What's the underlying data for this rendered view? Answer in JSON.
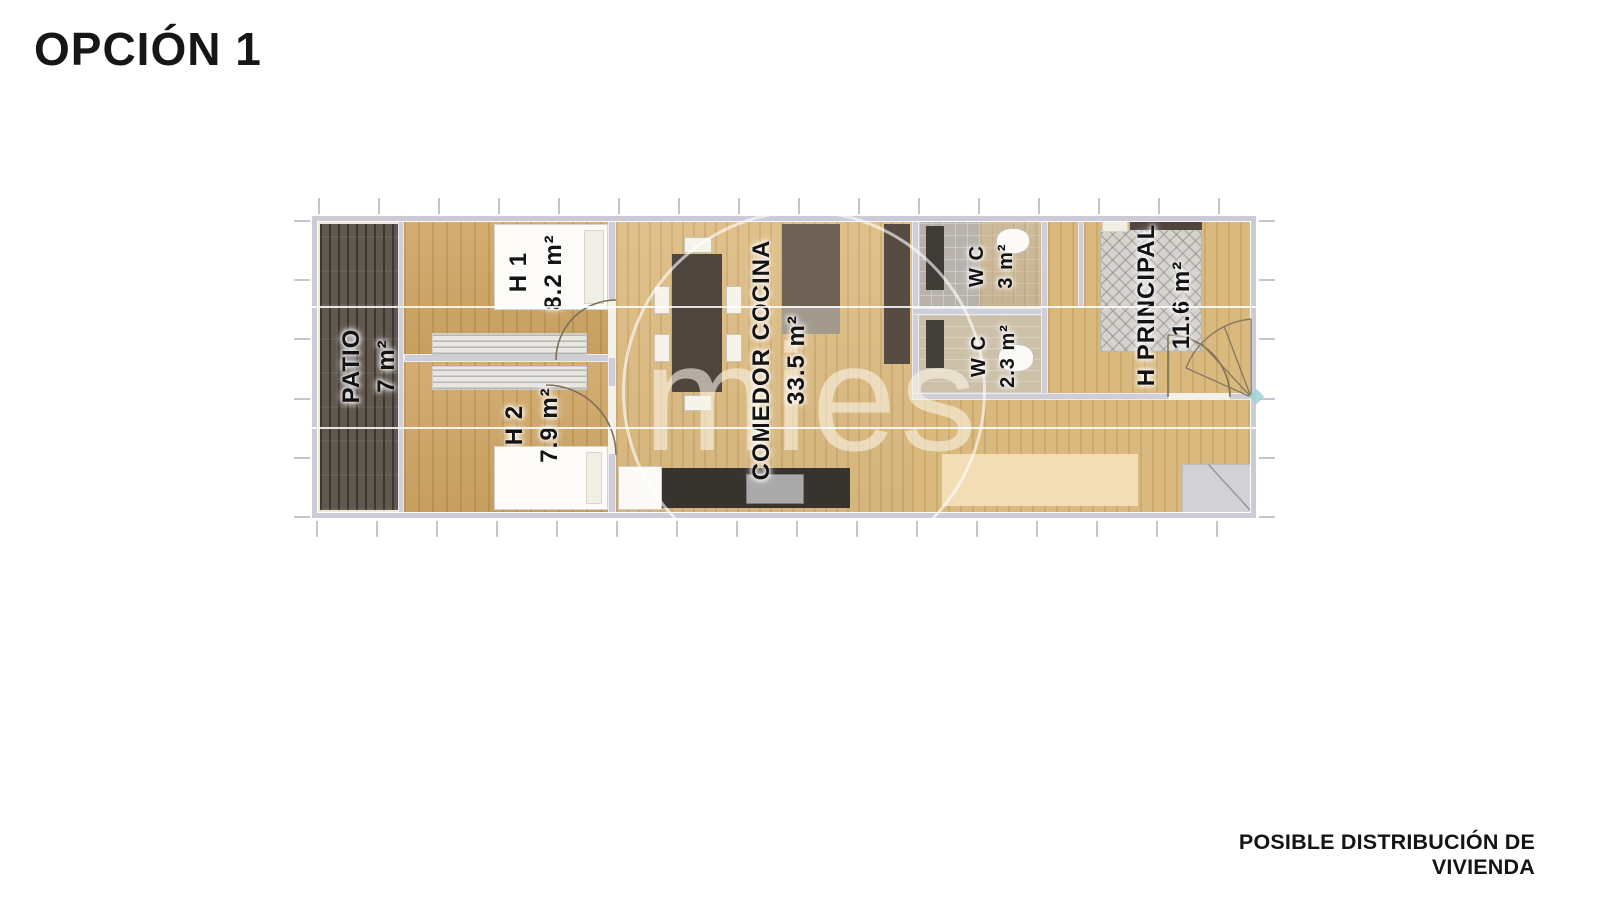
{
  "title": "OPCIÓN 1",
  "caption": "POSIBLE DISTRIBUCIÓN DE VIVIENDA",
  "watermark": "mies",
  "plan": {
    "rooms": [
      {
        "id": "patio",
        "name": "PATIO",
        "area": "7 m²"
      },
      {
        "id": "h1",
        "name": "H 1",
        "area": "8.2 m²"
      },
      {
        "id": "h2",
        "name": "H 2",
        "area": "7.9 m²"
      },
      {
        "id": "comedor",
        "name": "COMEDOR COCINA",
        "area": "33.5 m²"
      },
      {
        "id": "wc-top",
        "name": "W C",
        "area": "3 m²"
      },
      {
        "id": "wc-bottom",
        "name": "W C",
        "area": "2.3 m²"
      },
      {
        "id": "h-principal",
        "name": "H PRINCIPAL",
        "area": "11.6 m²"
      }
    ],
    "colors": {
      "wall": "#cccbd5",
      "wood_bedrooms": "#d0a765",
      "wood_living": "#ddbc82",
      "patio_deck": "#60574e",
      "kitchen_counter": "#37332f",
      "watermark": "#faf3e5"
    }
  }
}
